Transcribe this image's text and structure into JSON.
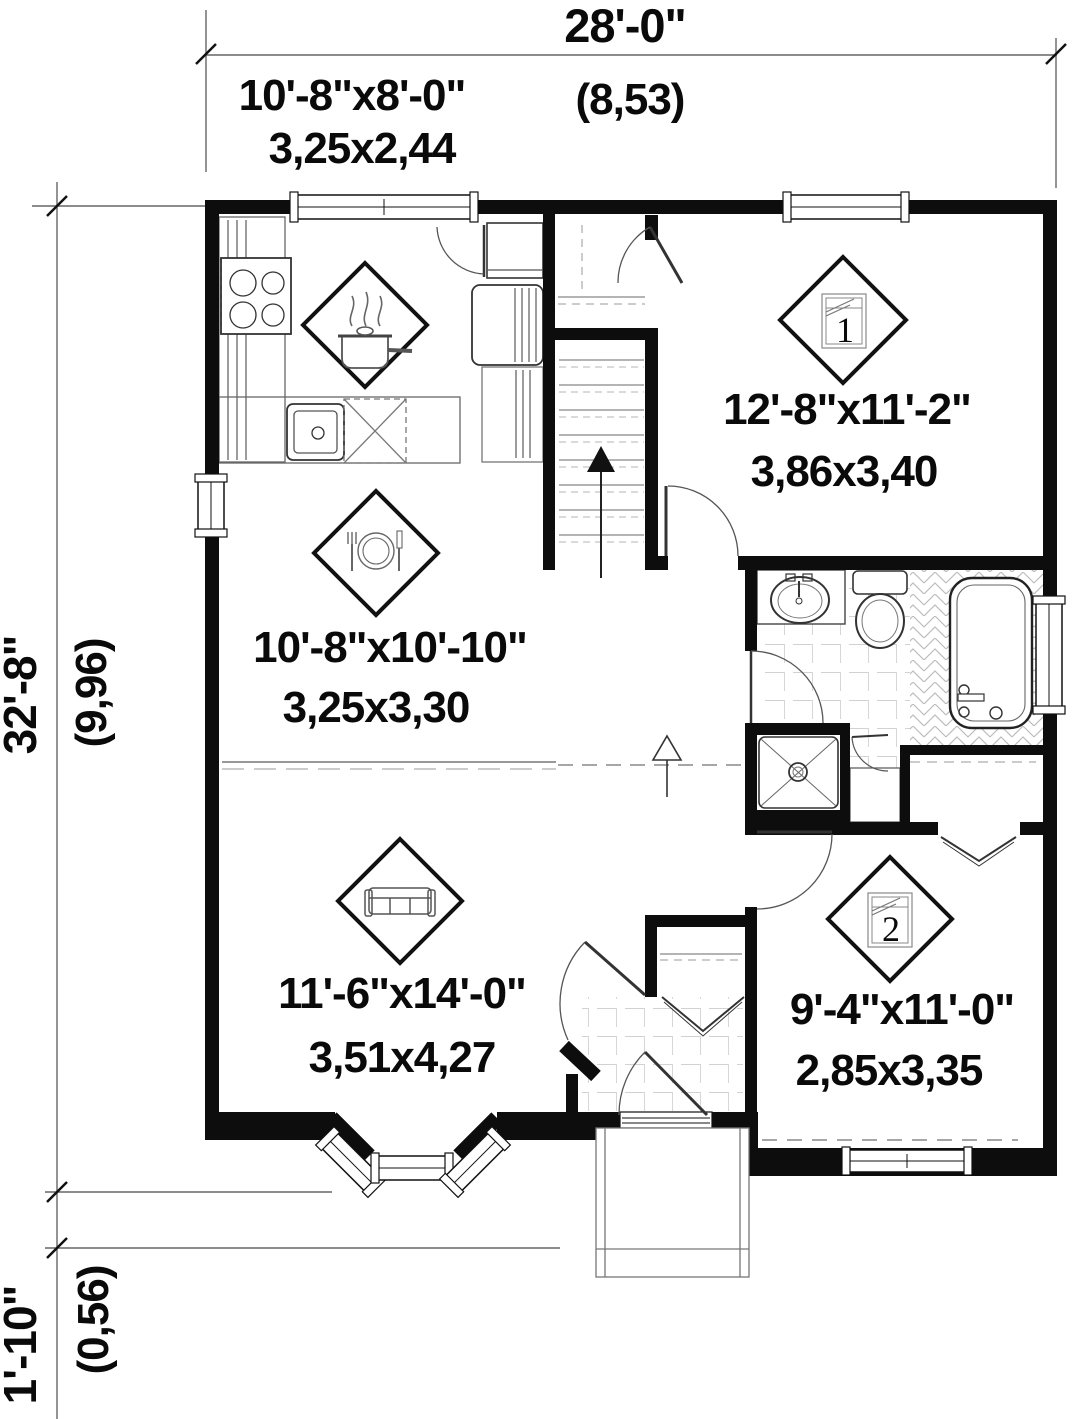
{
  "drawing_type": "first-floor-plan",
  "dimensions": {
    "overall_width": {
      "imperial": "28'-0\"",
      "metric": "(8,53)"
    },
    "overall_depth": {
      "imperial": "32'-8\"",
      "metric": "(9,96)"
    },
    "porch_projection": {
      "imperial": "1'-10\"",
      "metric": "(0,56)"
    }
  },
  "rooms": [
    {
      "id": "kitchen",
      "icon": "cooking-pot-icon",
      "imperial": "10'-8\"x8'-0\"",
      "metric": "3,25x2,44"
    },
    {
      "id": "dining",
      "icon": "plate-cutlery-icon",
      "imperial": "10'-8\"x10'-10\"",
      "metric": "3,25x3,30"
    },
    {
      "id": "living",
      "icon": "sofa-icon",
      "imperial": "11'-6\"x14'-0\"",
      "metric": "3,51x4,27"
    },
    {
      "id": "bedroom-1",
      "icon": "bed-icon",
      "bed_number": "1",
      "imperial": "12'-8\"x11'-2\"",
      "metric": "3,86x3,40"
    },
    {
      "id": "bedroom-2",
      "icon": "bed-icon",
      "bed_number": "2",
      "imperial": "9'-4\"x11'-0\"",
      "metric": "2,85x3,35"
    }
  ],
  "colors": {
    "wall": "#0d0d0d",
    "fixture_line": "#555555",
    "tile_line": "#c4c4c4",
    "text": "#0a0a0a",
    "background": "#ffffff"
  }
}
